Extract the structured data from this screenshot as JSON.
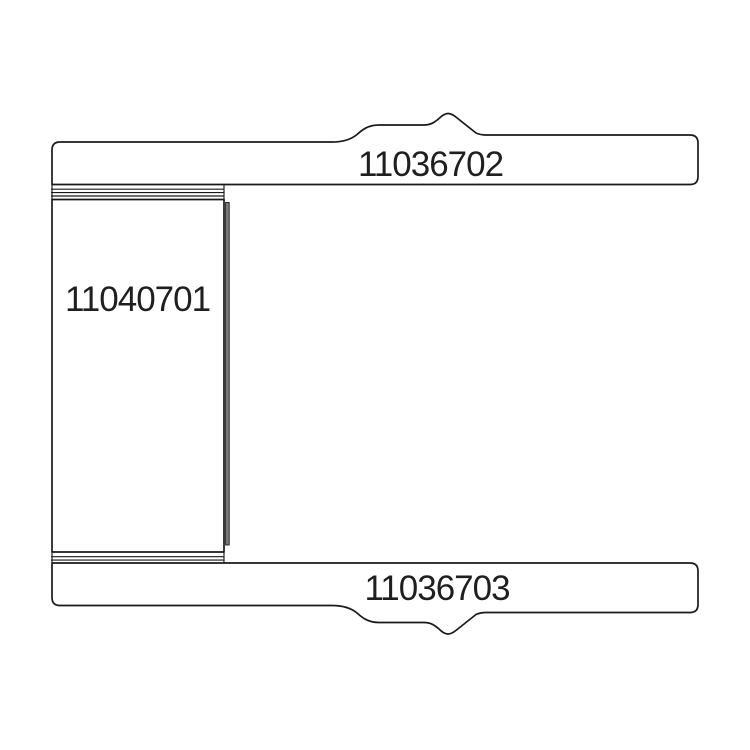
{
  "meta": {
    "kind": "technical-part-drawing",
    "background_color": "#ffffff"
  },
  "drawing": {
    "line_color": "#1a1a1a",
    "part_fill_color": "#ffffff",
    "seam_fill_color": "#7d7d7d",
    "label_color": "#1f1f1f",
    "parts": [
      {
        "name": "upper-plate",
        "label": "11036702"
      },
      {
        "name": "cylinder",
        "label": "11040701"
      },
      {
        "name": "lower-plate",
        "label": "11036703"
      }
    ]
  }
}
